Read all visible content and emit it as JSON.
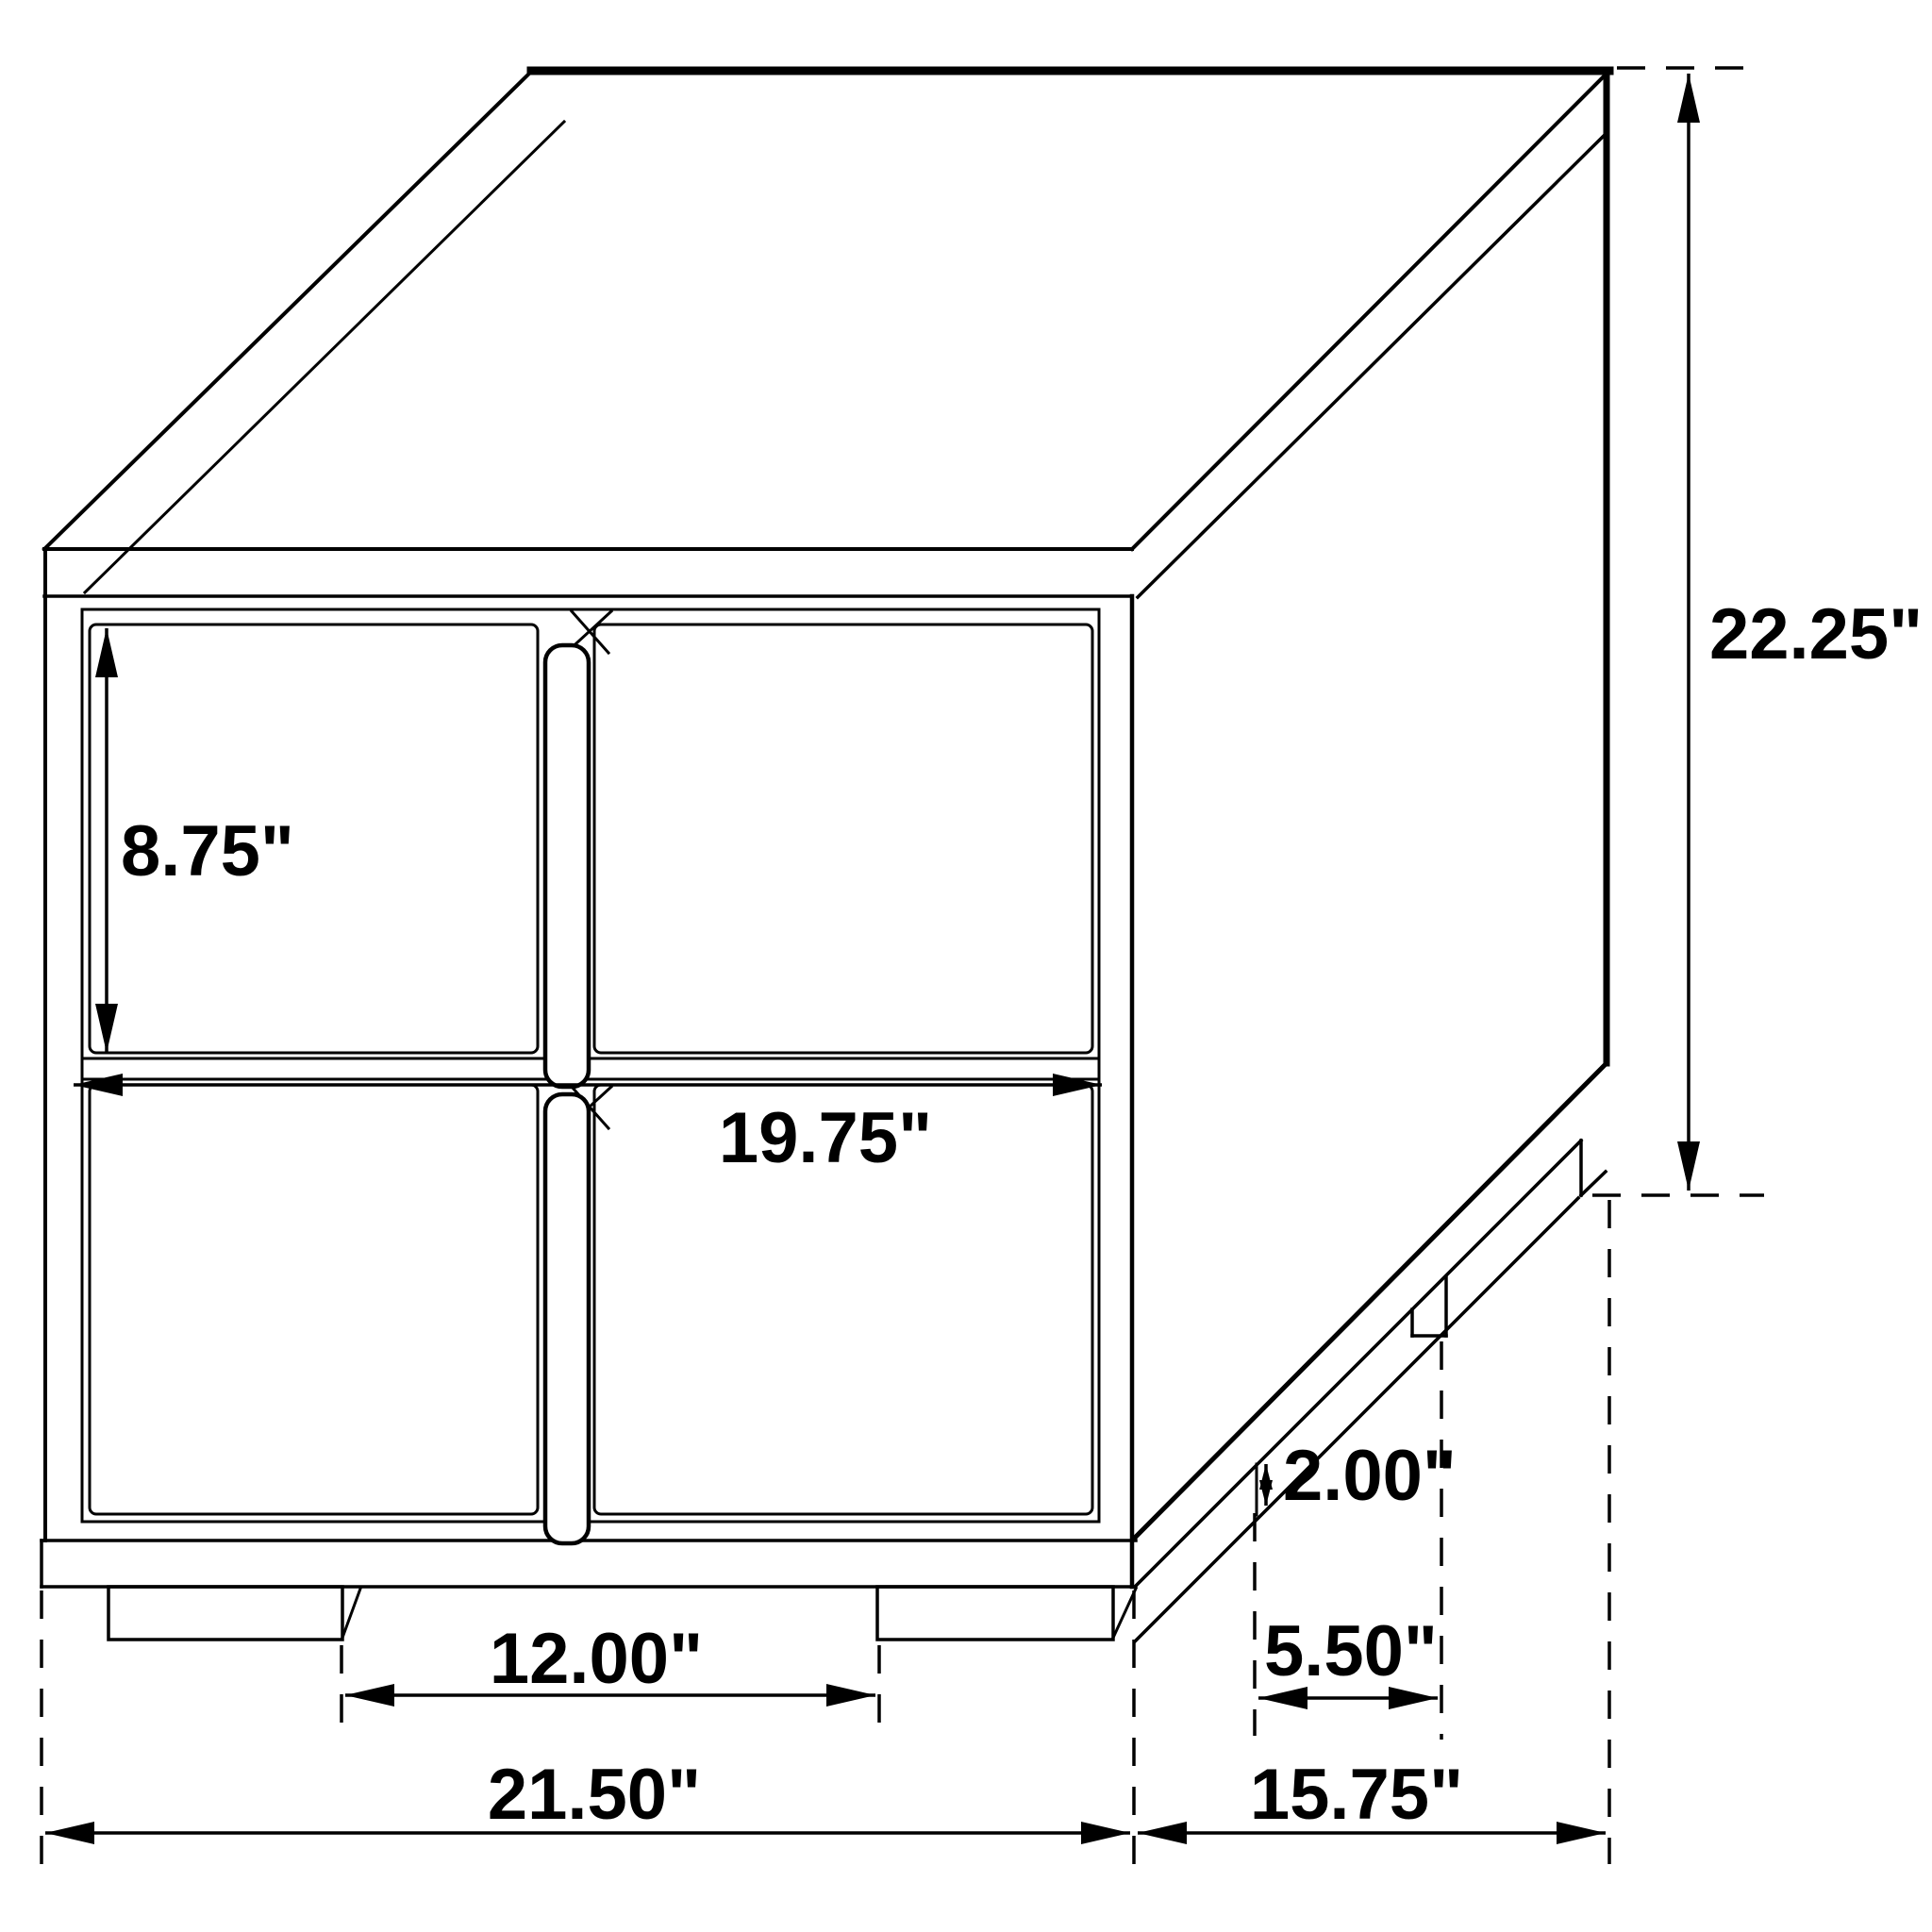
{
  "drawing": {
    "kind": "furniture-dimension-diagram",
    "item": "two-drawer nightstand line drawing",
    "line_color": "#000000",
    "background_color": "#ffffff"
  },
  "dimensions": {
    "drawer_height": "8.75\"",
    "front_width": "19.75\"",
    "overall_height": "22.25\"",
    "plinth_leg_height": "2.00\"",
    "side_leg_spacing": "5.50\"",
    "front_leg_spacing": "12.00\"",
    "overall_width": "21.50\"",
    "overall_depth": "15.75\""
  }
}
